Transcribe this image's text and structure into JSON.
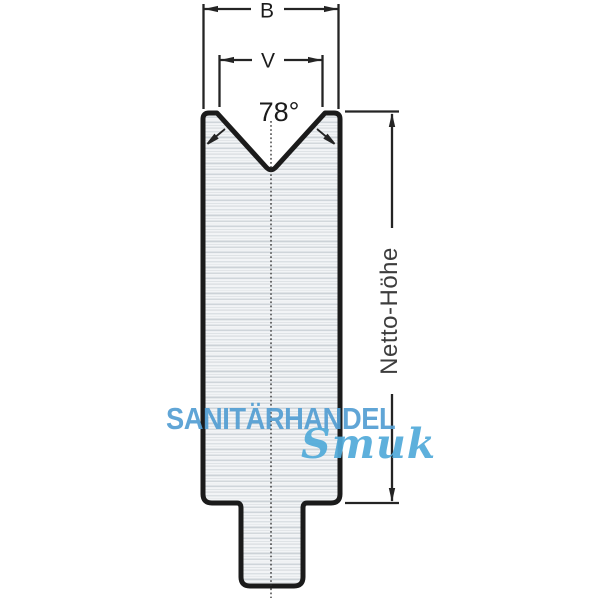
{
  "title": "V-die cross-section technical drawing",
  "labels": {
    "width": "B",
    "opening": "V",
    "angle": "78°",
    "height": "Netto-Höhe"
  },
  "watermark": {
    "line1": "SANITÄRHANDEL",
    "line2": "Smuk"
  },
  "colors": {
    "outline": "#1b1b1b",
    "dim_line": "#242424",
    "dim_text": "#3d3d3d",
    "watermark_primary": "#549fd3",
    "watermark_script": "#52abda",
    "metal_base": "#f2f4f6",
    "metal_streak": "#ccd2d7"
  }
}
